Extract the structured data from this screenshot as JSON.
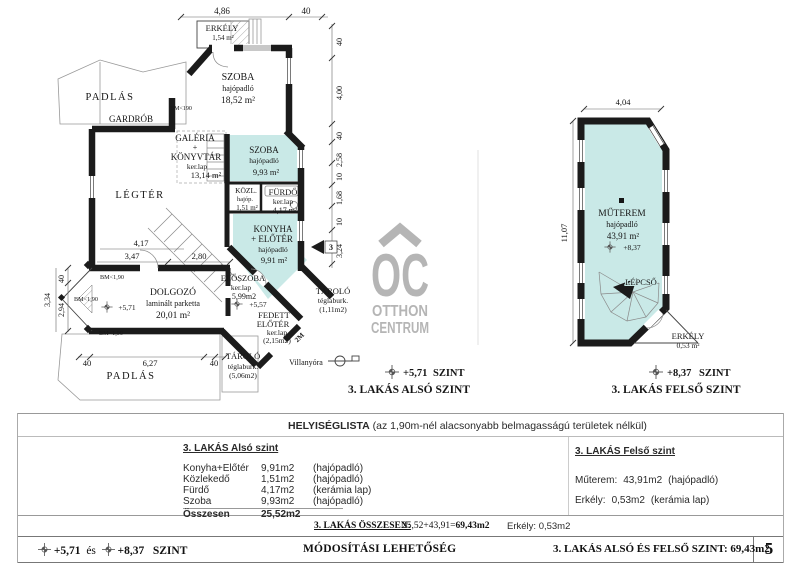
{
  "logo": {
    "mark": "OC",
    "line1": "OTTHON",
    "line2": "CENTRUM"
  },
  "lower_plan": {
    "caption": {
      "level": "+5,71",
      "szint": "SZINT",
      "title": "3. LAKÁS ALSÓ SZINT"
    },
    "dims": {
      "top": [
        "4,86",
        "40"
      ],
      "right": [
        "40",
        "4,00",
        "40",
        "2,58",
        "10",
        "1,68",
        "10",
        "3,24"
      ],
      "left": [
        "3,34",
        "40",
        "2,94"
      ],
      "bottom": [
        "40",
        "6,27",
        "40"
      ],
      "inner": [
        "4,17",
        "3,47",
        "2,80"
      ]
    },
    "rooms": {
      "erkely": {
        "name": "ERKÉLY",
        "area": "1,54 m²"
      },
      "szoba_nagy": {
        "name": "SZOBA",
        "floor": "hajópadló",
        "area": "18,52 m²"
      },
      "padlas_felso": {
        "name": "PADLÁS"
      },
      "gardrob": {
        "name": "GARDRÓB",
        "bm": "BM<190"
      },
      "galeria": {
        "name": "GALÉRIA",
        "plus": "+",
        "name2": "KÖNYVTÁR",
        "floor": "ker.lap",
        "area": "13,14 m²"
      },
      "szoba_kicsi": {
        "name": "SZOBA",
        "floor": "hajópadló",
        "area": "9,93 m²"
      },
      "kozlekedo": {
        "name": "KÖZL.",
        "floor": "hajóp.",
        "area": "1,51 m²"
      },
      "furdo": {
        "name": "FÜRDŐ",
        "floor": "ker.lap",
        "area": "4,17 m²"
      },
      "konyha": {
        "name": "KONYHA",
        "name2": "+ ELŐTÉR",
        "floor": "hajópadló",
        "area": "9,91 m²"
      },
      "legter": {
        "name": "LÉGTÉR"
      },
      "dolgozo": {
        "name": "DOLGOZÓ",
        "floor": "laminált parketta",
        "area": "20,01 m²",
        "level": "+5,71"
      },
      "eloszoba": {
        "name": "ELŐSZOBA",
        "floor": "ker.lap",
        "area": "5,99m2",
        "level": "+5,57"
      },
      "fedett_eloter": {
        "name": "FEDETT",
        "name2": "ELŐTÉR",
        "floor": "ker.lap",
        "area": "(2,15m2)"
      },
      "tarolo_felso": {
        "name": "TÁROLÓ",
        "floor": "téglaburk.",
        "area": "(1,11m2)"
      },
      "tarolo_also": {
        "name": "TÁROLÓ",
        "floor": "téglaburk.",
        "area": "(5,06m2)"
      },
      "padlas_also": {
        "name": "PADLÁS"
      },
      "villanyora": {
        "name": "Villanyóra"
      }
    },
    "bm_labels": [
      "BM<1,90",
      "BM<1,90",
      "BM<1,90"
    ],
    "unit_marker": "3",
    "door_label": "2M"
  },
  "upper_plan": {
    "caption": {
      "level": "+8,37",
      "szint": "SZINT",
      "title": "3. LAKÁS FELSŐ SZINT"
    },
    "dims": {
      "top": "4,04",
      "left": "11,07"
    },
    "rooms": {
      "muterem": {
        "name": "MŰTEREM",
        "floor": "hajópadló",
        "area": "43,91 m²",
        "level": "+8,37"
      },
      "lepcso": {
        "name": "LÉPCSŐ"
      },
      "erkely": {
        "name": "ERKÉLY",
        "area": "0,53 m²"
      }
    }
  },
  "room_list": {
    "header": {
      "bold": "HELYISÉGLISTA",
      "rest": " (az 1,90m-nél alacsonyabb belmagasságú területek nélkül)"
    },
    "lower": {
      "title": "3. LAKÁS Alsó szint",
      "rows": [
        {
          "name": "Konyha+Előtér",
          "area": "9,91m2",
          "floor": "(hajópadló)"
        },
        {
          "name": "Közlekedő",
          "area": "1,51m2",
          "floor": "(hajópadló)"
        },
        {
          "name": "Fürdő",
          "area": "4,17m2",
          "floor": "(kerámia lap)"
        },
        {
          "name": "Szoba",
          "area": "9,93m2",
          "floor": "(hajópadló)"
        }
      ],
      "total": {
        "label": "Összesen",
        "value": "25,52m2"
      }
    },
    "upper": {
      "title": "3. LAKÁS Felső szint",
      "rows": [
        {
          "name": "Műterem:",
          "area": "43,91m2",
          "floor": "(hajópadló)"
        },
        {
          "name": "Erkély:",
          "area": "0,53m2",
          "floor": "(kerámia lap)"
        }
      ]
    },
    "summary": {
      "label": "3. LAKÁS ÖSSZESEN:",
      "calc": "25,52+43,91=",
      "total": "69,43m2",
      "erkely_label": "Erkély:",
      "erkely_value": "0,53m2"
    }
  },
  "footer": {
    "level1": "+5,71",
    "and": "és",
    "level2": "+8,37",
    "szint": "SZINT",
    "center_title": "MÓDOSÍTÁSI LEHETŐSÉG",
    "right_title": "3. LAKÁS ALSÓ ÉS FELSŐ SZINT: 69,43m2",
    "page_number": "5"
  }
}
